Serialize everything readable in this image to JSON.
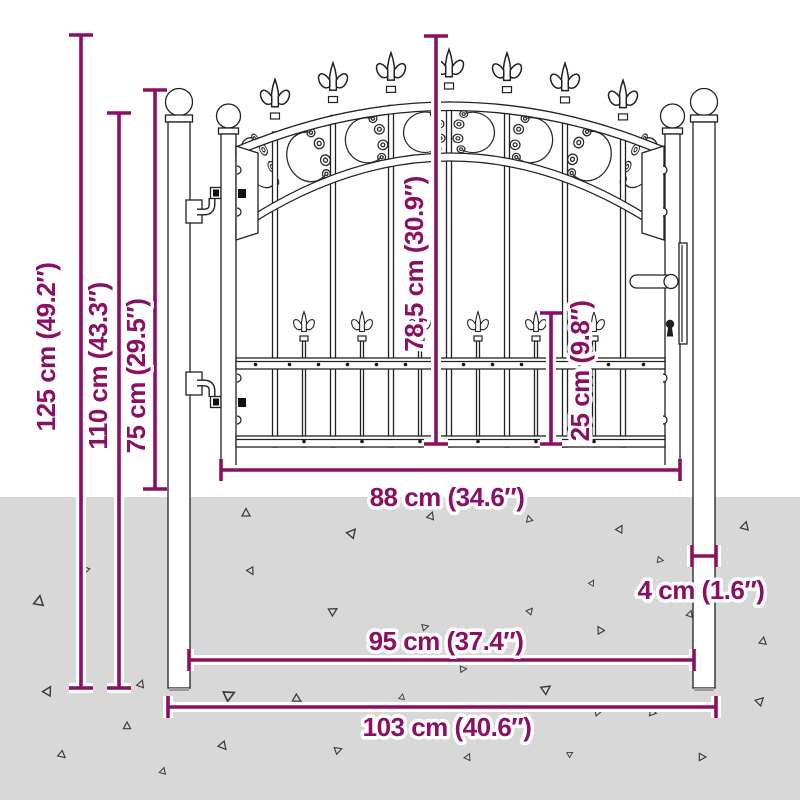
{
  "colors": {
    "accent": "#8b0f62",
    "ground": "#d8d8d8",
    "drawing_line": "#212121",
    "background": "#ffffff"
  },
  "measurements": [
    {
      "id": "overall-height",
      "label": "125 cm (49.2″)",
      "orientation": "vertical"
    },
    {
      "id": "post-height",
      "label": "110 cm (43.3″)",
      "orientation": "vertical"
    },
    {
      "id": "above-ground-height",
      "label": "75 cm (29.5″)",
      "orientation": "vertical"
    },
    {
      "id": "gate-leaf-height",
      "label": "78,5 cm (30.9″)",
      "orientation": "vertical"
    },
    {
      "id": "spear-section-height",
      "label": "25 cm (9.8″)",
      "orientation": "vertical"
    },
    {
      "id": "gate-leaf-width",
      "label": "88 cm (34.6″)",
      "orientation": "horizontal"
    },
    {
      "id": "inner-span",
      "label": "95 cm (37.4″)",
      "orientation": "horizontal"
    },
    {
      "id": "overall-width",
      "label": "103 cm (40.6″)",
      "orientation": "horizontal"
    },
    {
      "id": "post-width",
      "label": "4 cm (1.6″)",
      "orientation": "horizontal"
    }
  ]
}
